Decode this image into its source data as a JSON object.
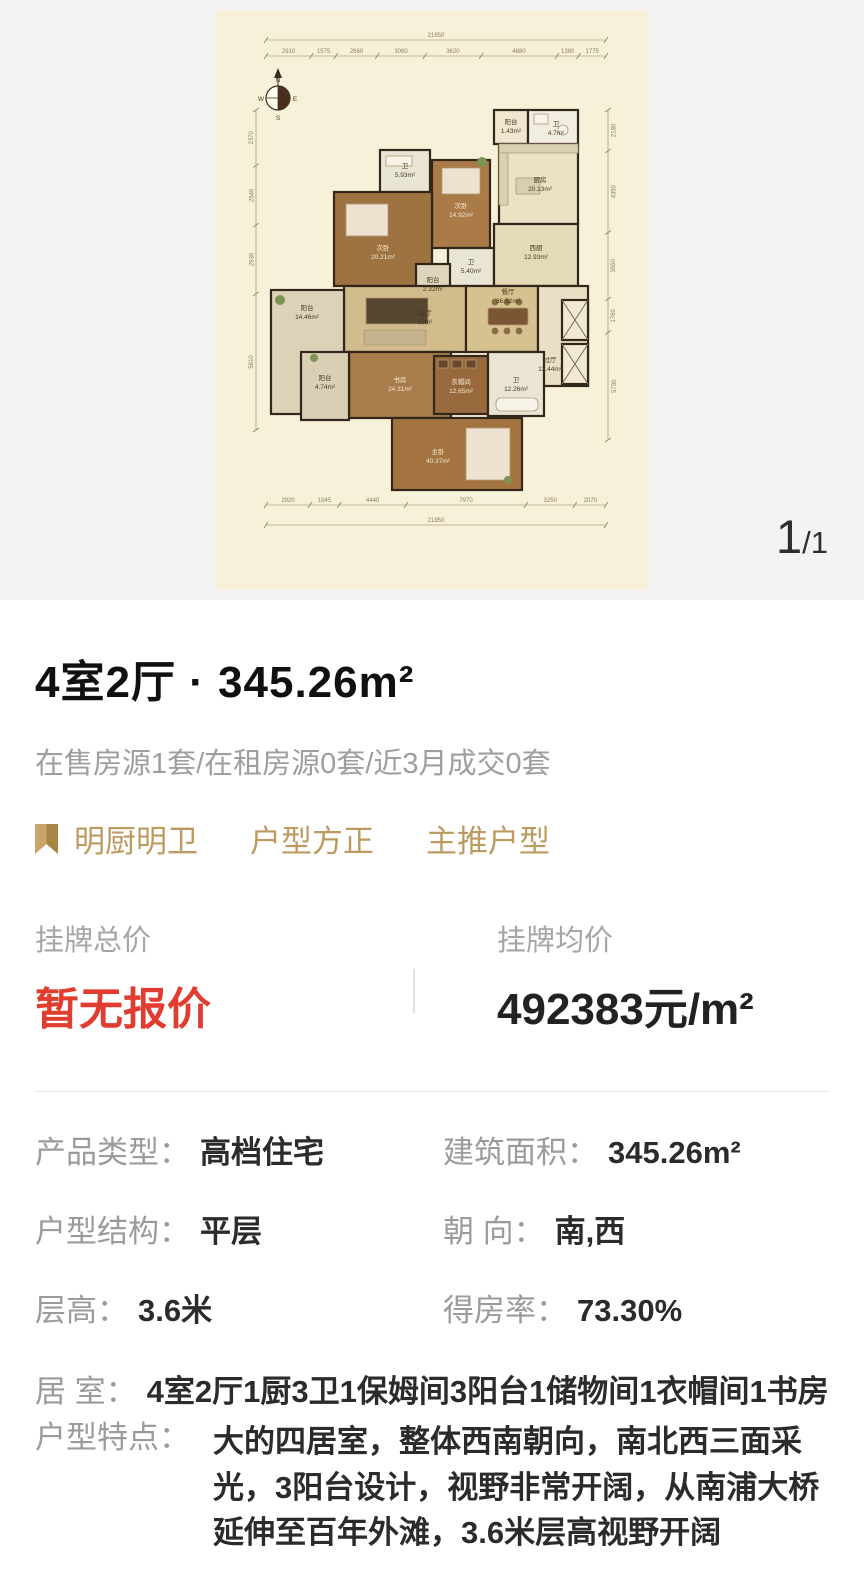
{
  "colors": {
    "accent_gold": "#bd9a5f",
    "price_red": "#e13c30",
    "label_gray": "#9b9b9b",
    "canvas_cream": "#f8f1d9",
    "section_bg": "#f3f3f4"
  },
  "floorplan": {
    "pager_current": "1",
    "pager_rest": "/1",
    "compass": {
      "n": "N",
      "e": "E",
      "s": "S",
      "w": "W"
    },
    "dims": {
      "top_total": "21850",
      "top_segments": [
        "2910",
        "1575",
        "2660",
        "3060",
        "3620",
        "4880",
        "1380",
        "1775"
      ],
      "bottom_total": "21850",
      "bottom_segments": [
        "2920",
        "1945",
        "4440",
        "7970",
        "3250",
        "2070"
      ],
      "left_segments": [
        "2370",
        "2540",
        "2930",
        "5810"
      ],
      "right_segments": [
        "2180",
        "4350",
        "3550",
        "1780",
        "5730"
      ]
    },
    "rooms": [
      {
        "name": "阳台",
        "area": "1.43m²"
      },
      {
        "name": "卫",
        "area": "4.7m²"
      },
      {
        "name": "厨房",
        "area": "20.13m²"
      },
      {
        "name": "卫",
        "area": "5.93m²"
      },
      {
        "name": "次卧",
        "area": "14.92m²"
      },
      {
        "name": "次卧",
        "area": "20.21m²"
      },
      {
        "name": "卫",
        "area": "5.40m²"
      },
      {
        "name": "阳台",
        "area": "2.32m²"
      },
      {
        "name": "西厨",
        "area": "12.93m²"
      },
      {
        "name": "客厅",
        "area": "55m²"
      },
      {
        "name": "餐厅",
        "area": "36.52m²"
      },
      {
        "name": "阳台",
        "area": "14.46m²"
      },
      {
        "name": "过厅",
        "area": "13.44m²"
      },
      {
        "name": "书房",
        "area": "24.31m²"
      },
      {
        "name": "阳台",
        "area": "4.74m²"
      },
      {
        "name": "衣帽间",
        "area": "12.65m²"
      },
      {
        "name": "卫",
        "area": "12.26m²"
      },
      {
        "name": "主卧",
        "area": "40.37m²"
      }
    ]
  },
  "summary": {
    "title": "4室2厅 · 345.26m²",
    "stats": "在售房源1套/在租房源0套/近3月成交0套",
    "tags": [
      "明厨明卫",
      "户型方正",
      "主推户型"
    ]
  },
  "price": {
    "total_label": "挂牌总价",
    "total_value": "暂无报价",
    "avg_label": "挂牌均价",
    "avg_value": "492383元/m²"
  },
  "details": {
    "rows": [
      {
        "label": "产品类型：",
        "value": "高档住宅"
      },
      {
        "label": "建筑面积：",
        "value": "345.26m²"
      },
      {
        "label": "户型结构：",
        "value": "平层"
      },
      {
        "label": "朝 向：",
        "value": "南,西"
      },
      {
        "label": "层高：",
        "value": "3.6米"
      },
      {
        "label": "得房率：",
        "value": "73.30%"
      },
      {
        "label": "居 室：",
        "value": "4室2厅1厨3卫1保姆间3阳台1储物间1衣帽间1书房"
      },
      {
        "label": "户型特点：",
        "value": "大的四居室，整体西南朝向，南北西三面采光，3阳台设计，视野非常开阔，从南浦大桥延伸至百年外滩，3.6米层高视野开阔"
      }
    ]
  }
}
